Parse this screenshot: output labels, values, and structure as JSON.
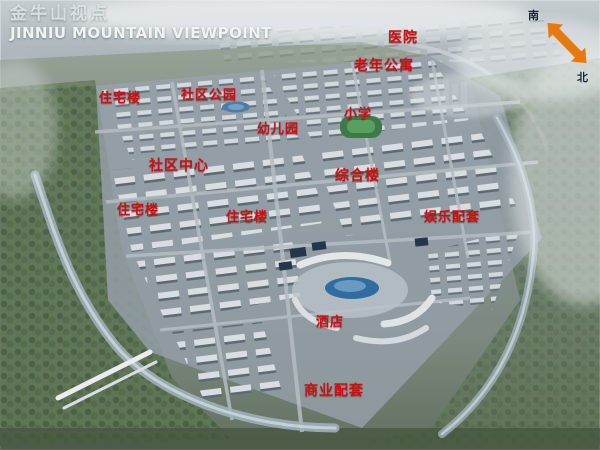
{
  "title": {
    "zh": "金牛山视点",
    "en": "JINNIU MOUNTAIN VIEWPOINT"
  },
  "compass": {
    "south": "南",
    "north": "北",
    "arrow_color": "#e8790f"
  },
  "labels": [
    {
      "id": "hospital",
      "text": "医院"
    },
    {
      "id": "senior-apartments",
      "text": "老年公寓"
    },
    {
      "id": "residential-building-1",
      "text": "住宅楼"
    },
    {
      "id": "community-park",
      "text": "社区公园"
    },
    {
      "id": "primary-school",
      "text": "小学"
    },
    {
      "id": "kindergarten",
      "text": "幼儿园"
    },
    {
      "id": "community-center",
      "text": "社区中心"
    },
    {
      "id": "complex-building",
      "text": "综合楼"
    },
    {
      "id": "residential-building-2",
      "text": "住宅楼"
    },
    {
      "id": "residential-building-3",
      "text": "住宅楼"
    },
    {
      "id": "entertainment-facilities",
      "text": "娱乐配套"
    },
    {
      "id": "hotel",
      "text": "酒店"
    },
    {
      "id": "commercial-facilities",
      "text": "商业配套"
    }
  ],
  "colors": {
    "label_red": "#c81212",
    "title_white": "#eff3f4",
    "arrow_orange": "#e8790f"
  }
}
